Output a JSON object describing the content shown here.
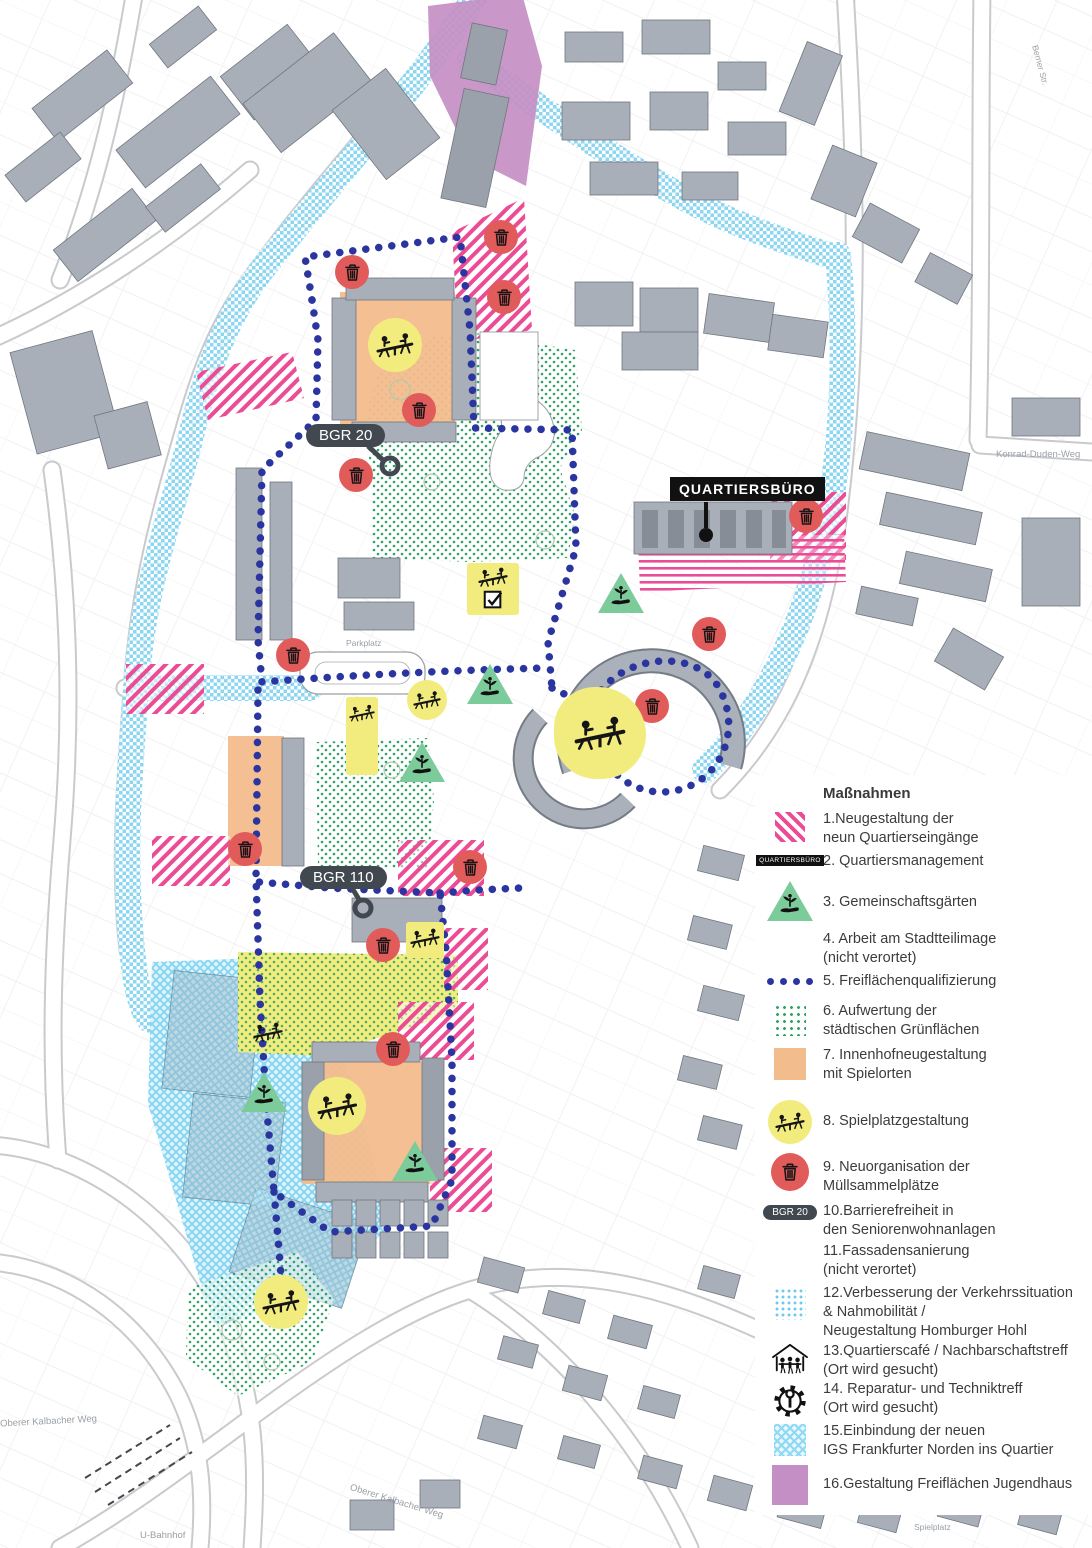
{
  "map": {
    "labels": {
      "quartiersbuero": "QUARTIERSBÜRO",
      "bgr20": "BGR 20",
      "bgr110": "BGR 110",
      "parkplatz": "Parkplatz",
      "konrad_duden_weg": "Konrad-Duden-Weg",
      "berner_str": "Berner Str.",
      "oberer_kalbacher_weg_left": "Oberer Kalbacher Weg",
      "oberer_kalbacher_weg_right": "Oberer Kalbacher Weg",
      "u_bahnhof": "U-Bahnhof",
      "spielplatz": "Spielplatz"
    },
    "colors": {
      "entrance_pink": "#EC4C95",
      "route_navy": "#2A35A0",
      "green_dots": "#2FA365",
      "traffic_lightblue": "#8BD7F2",
      "courtyard_orange": "#F3BC8C",
      "playground_yellow": "#F2EC7E",
      "waste_red": "#E25B5B",
      "jugendhaus_purple": "#C48FC4",
      "building_gray": "#A9AFB9"
    }
  },
  "legend": {
    "title": "Maßnahmen",
    "chip_label": "QUARTIERSBÜRO",
    "pill_label": "BGR 20",
    "items": [
      {
        "label": "1.Neugestaltung der\nneun Quartierseingänge"
      },
      {
        "label": "2. Quartiersmanagement"
      },
      {
        "label": "3. Gemeinschaftsgärten"
      },
      {
        "label": "4. Arbeit am Stadtteilimage\n(nicht verortet)"
      },
      {
        "label": "5. Freiflächenqualifizierung"
      },
      {
        "label": "6. Aufwertung der\nstädtischen Grünflächen"
      },
      {
        "label": "7. Innenhofneugestaltung\nmit Spielorten"
      },
      {
        "label": "8. Spielplatzgestaltung"
      },
      {
        "label": "9. Neuorganisation der\nMüllsammelplätze"
      },
      {
        "label": "10.Barrierefreiheit in\nden Seniorenwohnanlagen"
      },
      {
        "label": "11.Fassadensanierung\n(nicht verortet)"
      },
      {
        "label": "12.Verbesserung der Verkehrssituation\n& Nahmobilität /\nNeugestaltung Homburger Hohl"
      },
      {
        "label": "13.Quartierscafé / Nachbarschaftstreff\n(Ort wird gesucht)"
      },
      {
        "label": "14. Reparatur- und Techniktreff\n(Ort wird gesucht)"
      },
      {
        "label": "15.Einbindung der neuen\nIGS Frankfurter Norden ins Quartier"
      },
      {
        "label": "16.Gestaltung Freiflächen Jugendhaus"
      }
    ]
  }
}
